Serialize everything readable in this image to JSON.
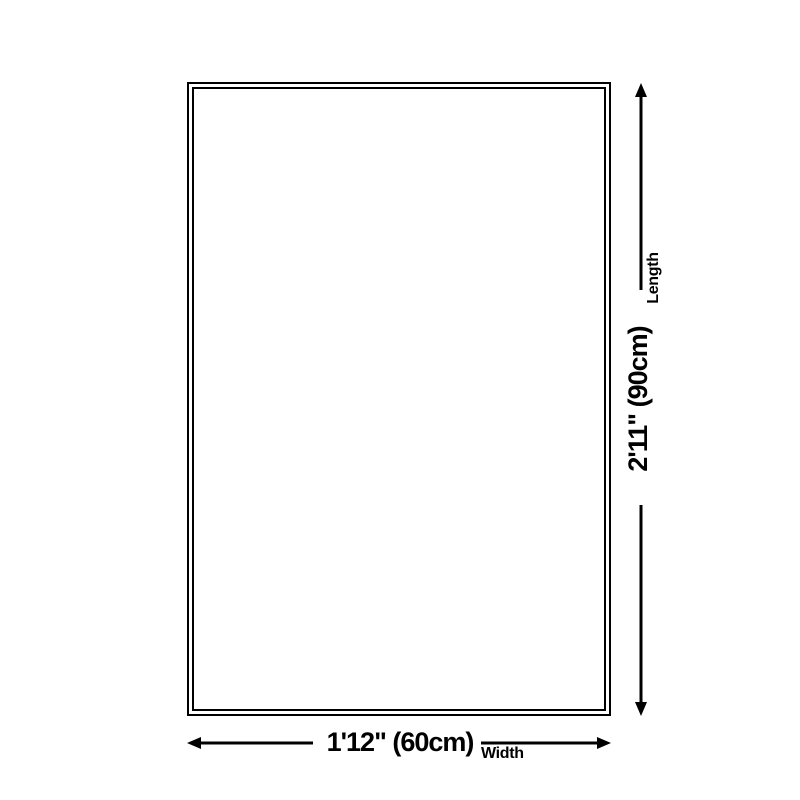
{
  "colors": {
    "line": "#000000",
    "background": "#ffffff"
  },
  "diagram": {
    "length_dimension": {
      "value": "2'11\" (90cm)",
      "axis_label": "Length"
    },
    "width_dimension": {
      "value": "1'12\" (60cm)",
      "axis_label": "Width"
    }
  }
}
